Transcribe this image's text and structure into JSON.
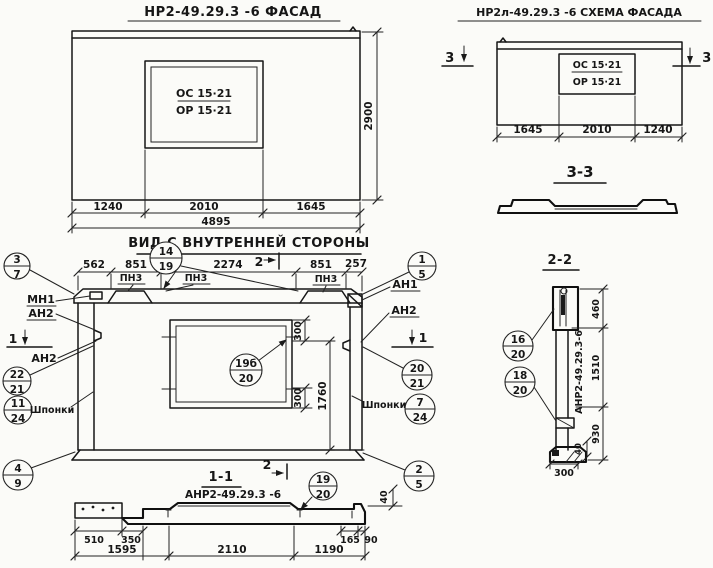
{
  "facade": {
    "title": "НР2-49.29.3 -6  ФАСАД",
    "mark_top": "ОС 15·21",
    "mark_bottom": "ОР 15·21",
    "dim_left": "1240",
    "dim_mid": "2010",
    "dim_right": "1645",
    "dim_total": "4895",
    "dim_height": "2900"
  },
  "scheme": {
    "title": "НР2л-49.29.3 -6 СХЕМА ФАСАДА",
    "mark_top": "ОС 15·21",
    "mark_bottom": "ОР 15·21",
    "dim_left": "1645",
    "dim_mid": "2010",
    "dim_right": "1240",
    "cut_label": "3",
    "section_title": "3-3"
  },
  "inner": {
    "title": "ВИД С ВНУТРЕННЕЙ СТОРОНЫ",
    "dims_top": [
      "562",
      "851",
      "2274",
      "851",
      "257"
    ],
    "dim_win_top": "300",
    "dim_win_bottom": "300",
    "dim_win_height": "1760",
    "dim_ledge": "40",
    "label_pn3": "ПН3",
    "label_mn1": "МН1",
    "label_an1": "АН1",
    "label_an2": "АН2",
    "label_keys": "Шпонки",
    "cut1": "1",
    "cut2": "2"
  },
  "sec11": {
    "title": "1-1",
    "label": "АНР2-49.29.3 -6",
    "dims_small": [
      "510",
      "350",
      "165",
      "90"
    ],
    "dims_main": [
      "1595",
      "2110",
      "1190"
    ]
  },
  "sec22": {
    "title": "2-2",
    "label_vertical": "АНР2-49.29.3-6",
    "dim_top": "460",
    "dim_mid": "1510",
    "dim_bottom": "930",
    "dim_small": "40",
    "dim_width": "300"
  },
  "callouts": {
    "c14_19": {
      "n": "14",
      "d": "19"
    },
    "c3_7": {
      "n": "3",
      "d": "7"
    },
    "c1_5": {
      "n": "1",
      "d": "5"
    },
    "c22_21": {
      "n": "22",
      "d": "21"
    },
    "c11_24": {
      "n": "11",
      "d": "24"
    },
    "c4_9": {
      "n": "4",
      "d": "9"
    },
    "c20_21": {
      "n": "20",
      "d": "21"
    },
    "c7_24": {
      "n": "7",
      "d": "24"
    },
    "c2_5": {
      "n": "2",
      "d": "5"
    },
    "c19b_20": {
      "n": "19б",
      "d": "20"
    },
    "c19_20": {
      "n": "19",
      "d": "20"
    },
    "c16_20": {
      "n": "16",
      "d": "20"
    },
    "c18_20": {
      "n": "18",
      "d": "20"
    }
  }
}
